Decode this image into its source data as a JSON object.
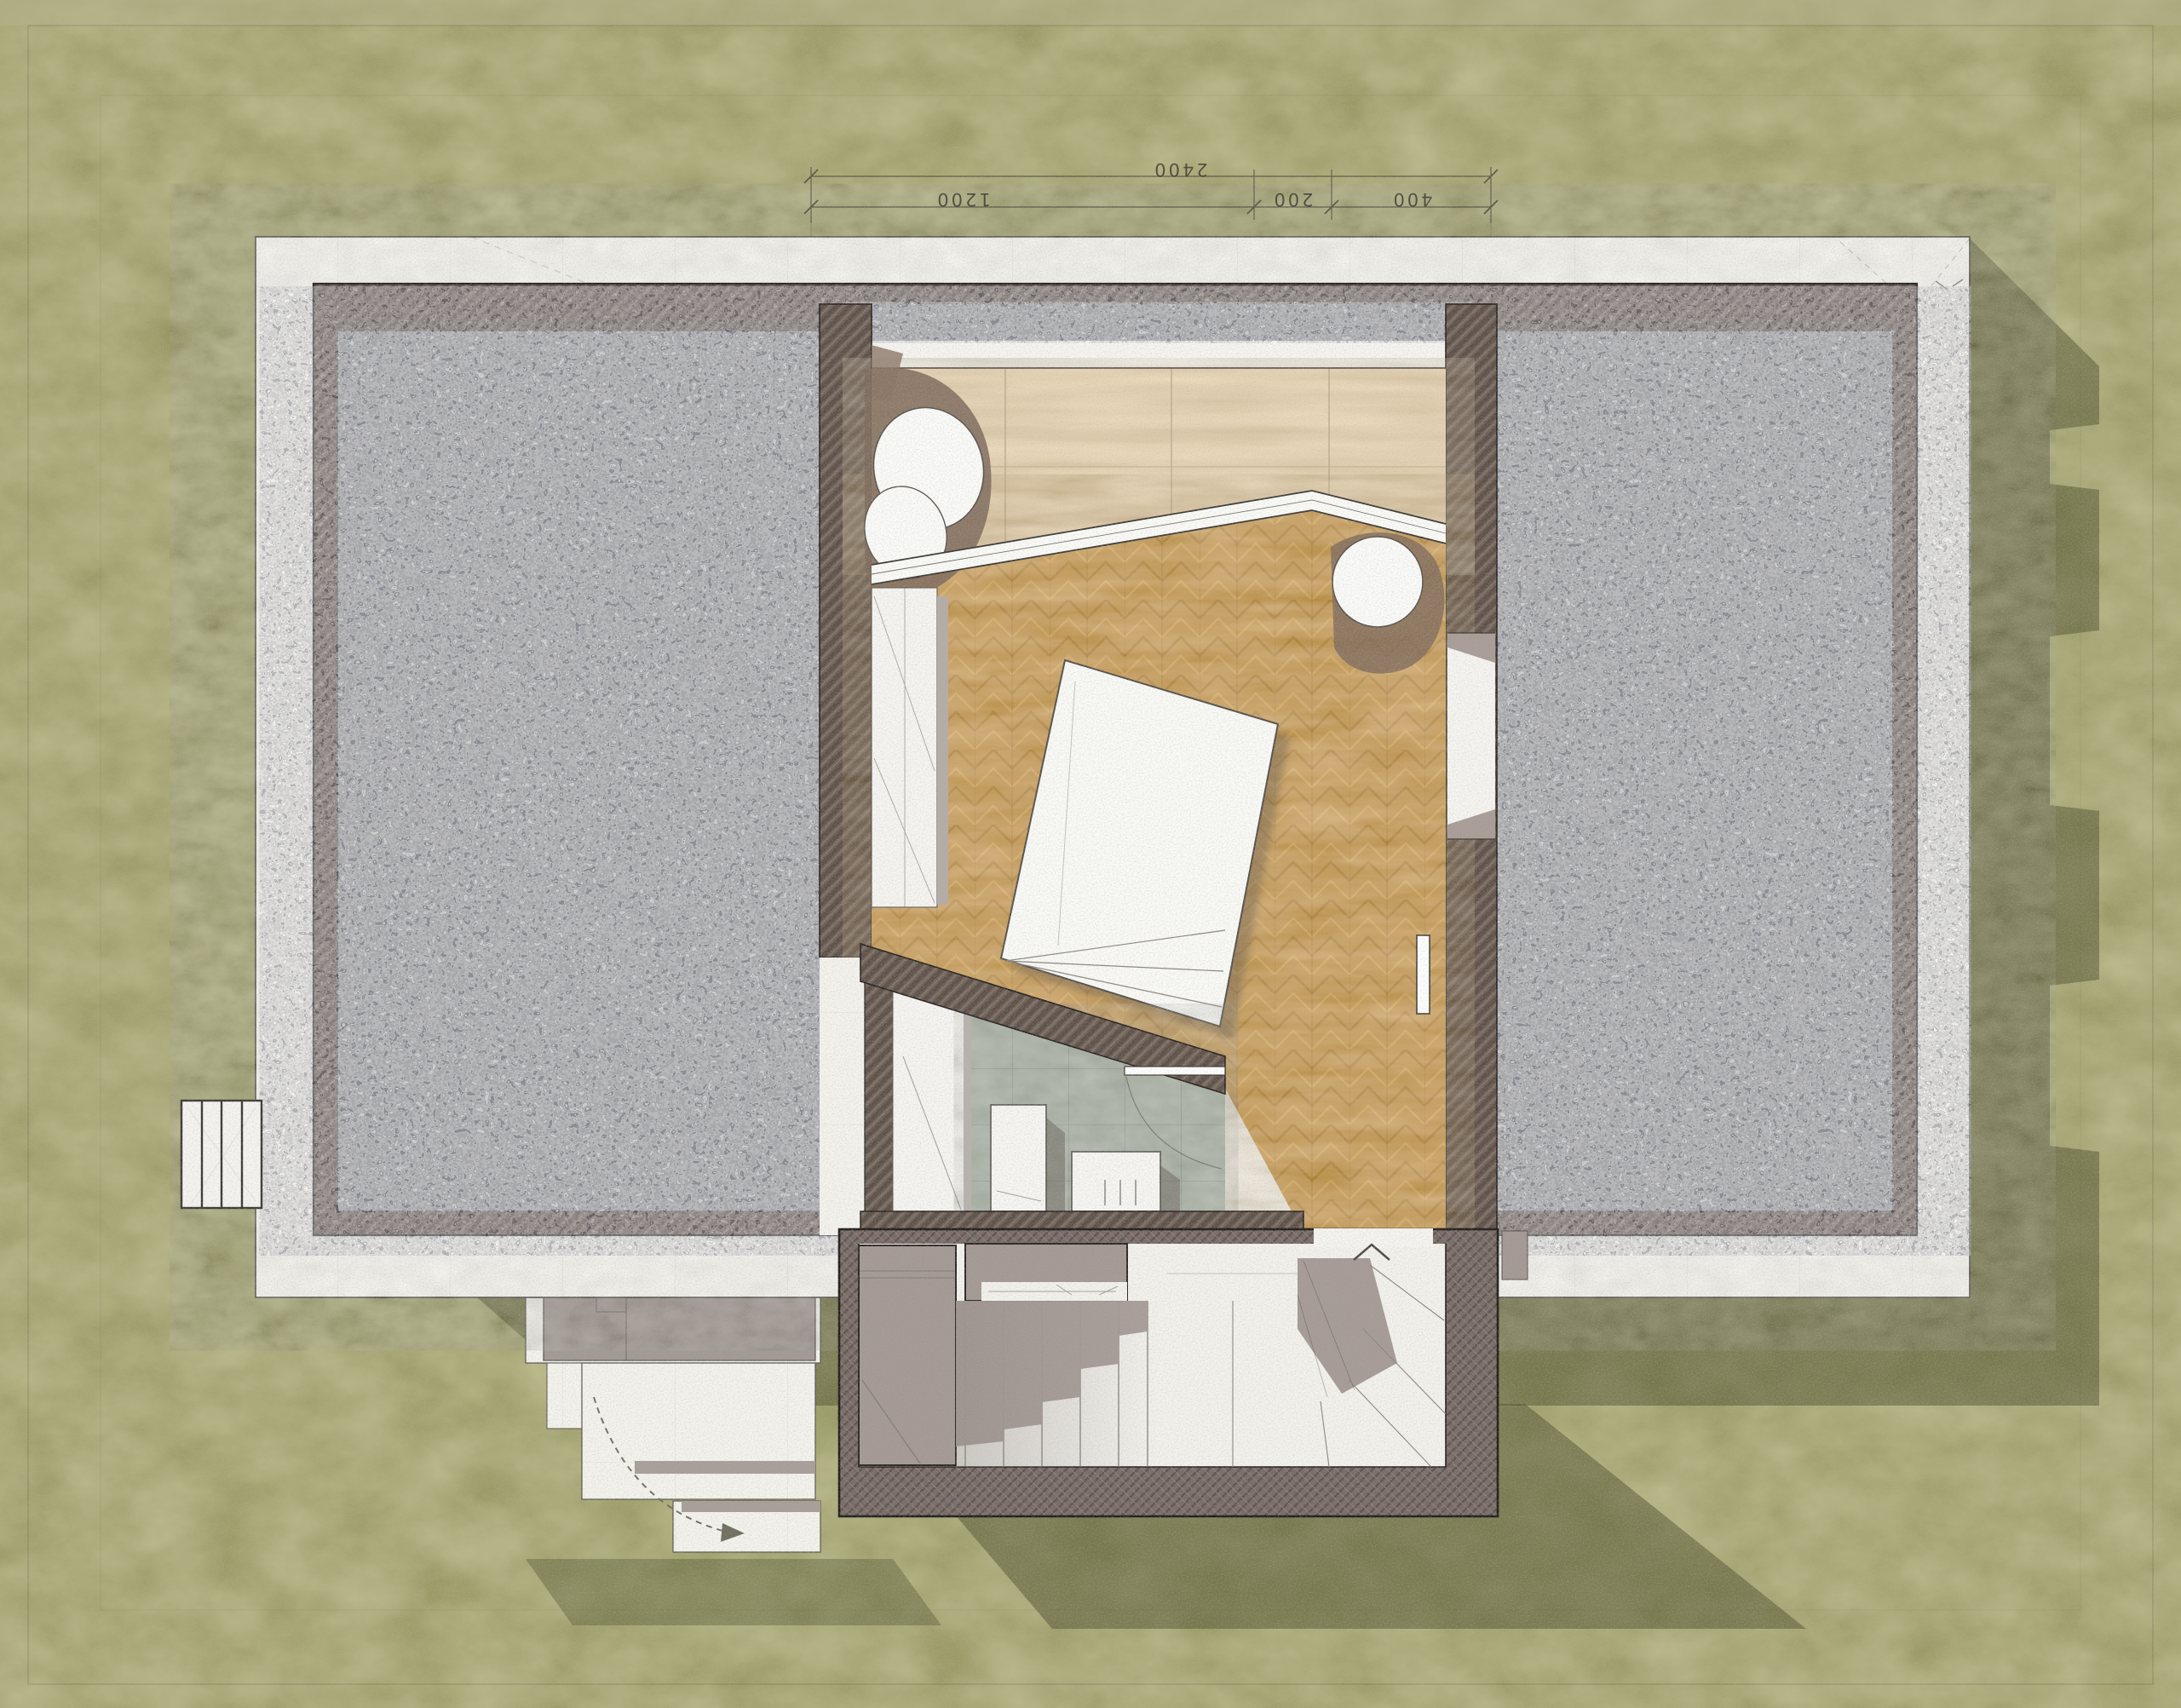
{
  "document": {
    "kind": "architectural floor plan, watercolor-sketch style, top-down view",
    "sheet": "bedroom level plan with roof gravel fields, garden, and exterior stair"
  },
  "dimension_annotations": {
    "overall": {
      "label": "2400"
    },
    "segments": [
      {
        "label": "1200"
      },
      {
        "label": "200"
      },
      {
        "label": "400"
      }
    ]
  },
  "markers": {
    "stair_direction": "chevron-up"
  },
  "palette": {
    "grass": "#a8a679",
    "grass_shadow": "#4d502e",
    "gravel": "#97999c",
    "wall_hatch_brown": "#6e6057",
    "wall_hatch_mauve": "#786b67",
    "plaster_band": "#f4f3ee",
    "travertine": "#e6d2b2",
    "parquet": "#c59a55",
    "bath_tile": "#a9b1a4",
    "landing_gray": "#a39894",
    "paper_white": "#f6f5f1",
    "ink": "#3f3d33"
  }
}
